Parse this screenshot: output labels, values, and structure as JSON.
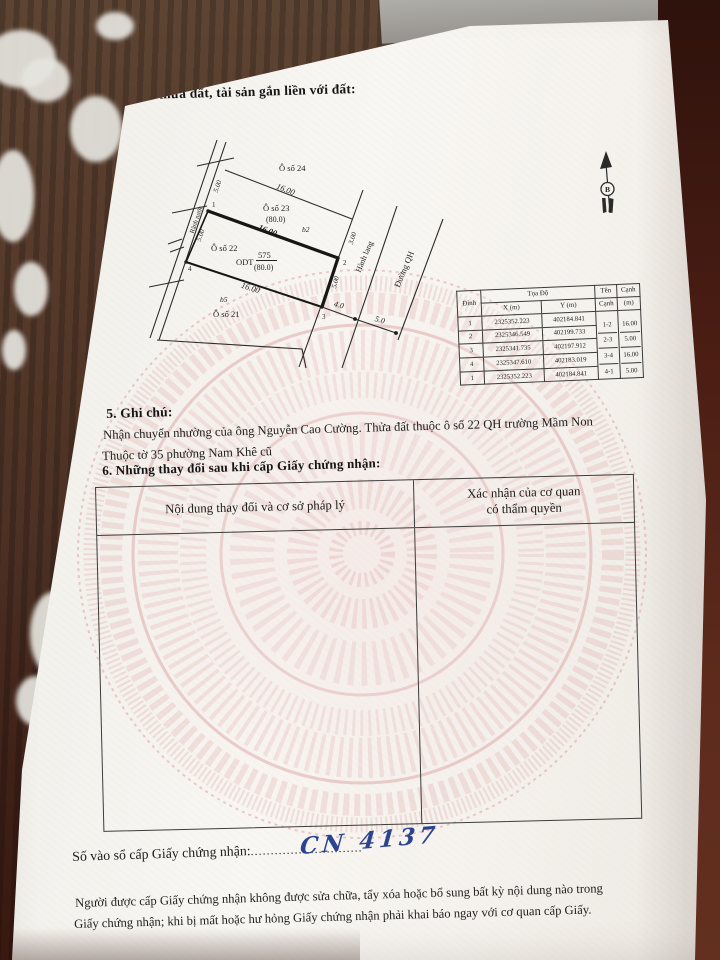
{
  "page": {
    "section4_title": "4. Sơ đồ thửa đất, tài sản gắn liền với đất:",
    "section5_title": "5. Ghi chú:",
    "note_line1": "Nhận chuyển nhường của ông Nguyễn Cao Cường. Thửa đất thuộc ô số 22 QH trường Mầm Non",
    "note_line2": "Thuộc tờ 35 phường Nam Khê cũ",
    "section6_title": "6. Những thay đổi sau khi cấp Giấy chứng nhận:",
    "footer_line1": "Người được cấp Giấy chứng nhận không được sửa chữa, tẩy xóa hoặc bổ sung bất kỳ nội dung nào trong",
    "footer_line2": "Giấy chứng nhận; khi bị mất hoặc hư hỏng Giấy chứng nhận phải khai báo ngay với cơ quan cấp Giấy."
  },
  "changes_table": {
    "col1_header": "Nội dung thay đổi và cơ sở pháp lý",
    "col2_header_line1": "Xác nhận của cơ quan",
    "col2_header_line2": "có thẩm quyền"
  },
  "serial": {
    "label": "Số vào sổ cấp Giấy chứng nhận:",
    "dots_left": "....................",
    "value": "CN 4137",
    "dots_right": "........"
  },
  "coord_table": {
    "header": {
      "dinh": "Đỉnh",
      "toado": "Tọa Độ",
      "x": "X (m)",
      "y": "Y (m)",
      "ten": "Tên",
      "canh": "Cạnh",
      "canh2": "Cạnh",
      "m": "(m)"
    },
    "rows": [
      [
        "1",
        "2325352.223",
        "402184.841"
      ],
      [
        "2",
        "2325346.549",
        "402199.733"
      ],
      [
        "3",
        "2325341.735",
        "402197.912"
      ],
      [
        "4",
        "2325347.610",
        "402183.019"
      ],
      [
        "1",
        "2325352.223",
        "402184.841"
      ]
    ],
    "edges": [
      [
        "1-2",
        "16.00"
      ],
      [
        "2-3",
        "5.00"
      ],
      [
        "3-4",
        "16.00"
      ],
      [
        "4-1",
        "5.00"
      ]
    ]
  },
  "diagram": {
    "labels": {
      "o24": "Ô số 24",
      "len_top": "16.00",
      "o23": "Ô số 23",
      "o23_area": "(80.0)",
      "b2": "b2",
      "len_12": "16.00",
      "o22": "Ô số 22",
      "odt": "ODT",
      "area_num": "575",
      "area_den": "(80.0)",
      "len_43": "16.00",
      "b5": "b5",
      "o21": "Ô số 21",
      "v1": "1",
      "v2": "2",
      "v3": "3",
      "v4": "4",
      "d5_a": "5.00",
      "d5_b": "5.00",
      "d5_c": "5.00",
      "d3": "3.00",
      "d40": "4.0",
      "d50": "5.0",
      "road": "Rãnh nước",
      "corridor": "Hành lang",
      "planned_road": "Đường QH",
      "north_letter": "B"
    }
  },
  "colors": {
    "ink": "#1f1f1d",
    "handwriting_blue": "#2c448f",
    "watermark_pink": "#dca4a4",
    "paper": "#f5f2ed"
  }
}
